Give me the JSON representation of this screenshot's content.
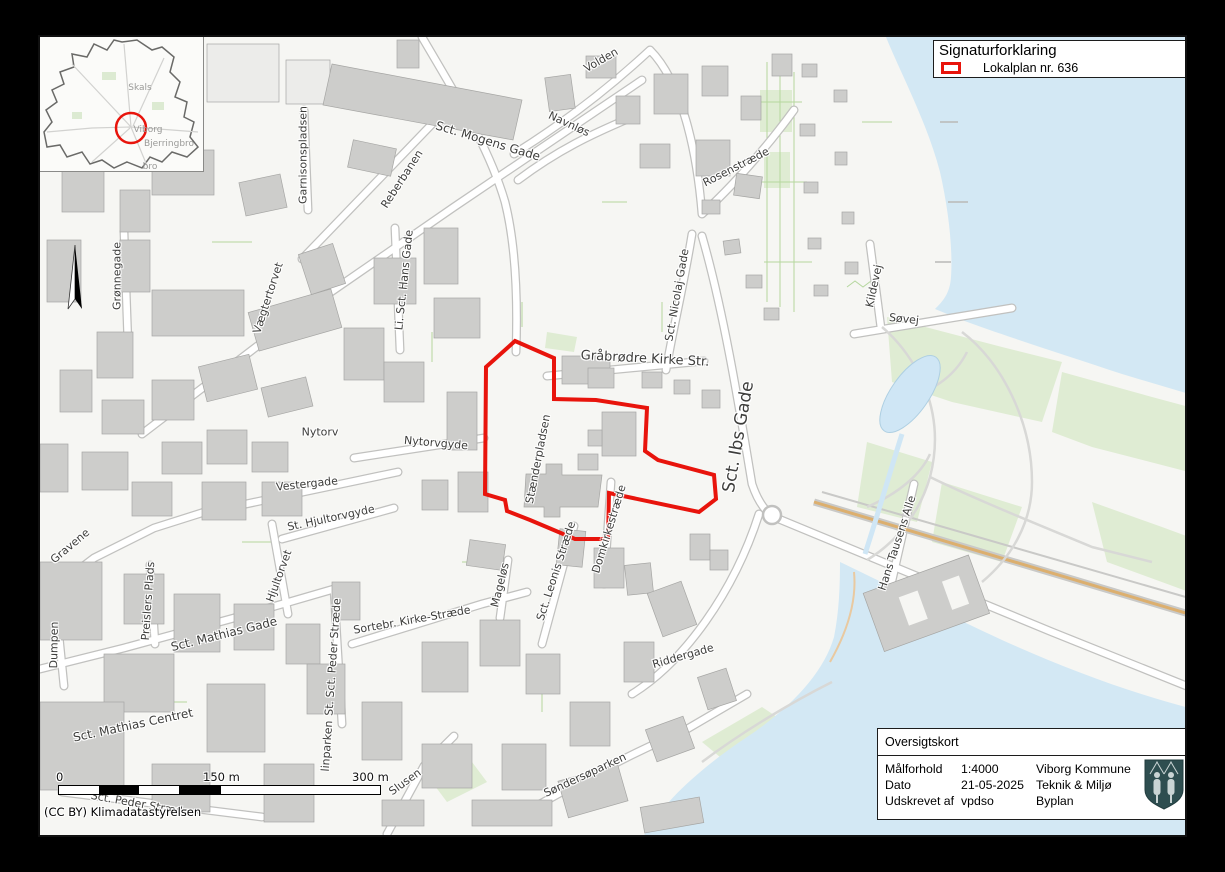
{
  "legend": {
    "title": "Signaturforklaring",
    "items": [
      {
        "label": "Lokalplan nr. 636",
        "symbol": "red-rectangle-outline",
        "color": "#e8140c"
      }
    ]
  },
  "info_box": {
    "title": "Oversigtskort",
    "rows": [
      {
        "label": "Målforhold",
        "value": "1:4000"
      },
      {
        "label": "Dato",
        "value": "21-05-2025"
      },
      {
        "label": "Udskrevet af",
        "value": "vpdso"
      }
    ],
    "org_lines": [
      "Viborg Kommune",
      "Teknik & Miljø",
      "Byplan"
    ],
    "emblem": "viborg-coat-of-arms"
  },
  "scale_bar": {
    "ticks": [
      "0",
      "150 m",
      "300 m"
    ]
  },
  "attribution": "(CC BY) Klimadatastyrelsen",
  "inset": {
    "marker": "red-circle",
    "labels": [
      {
        "text": "Skals",
        "x": 138,
        "y": 86
      },
      {
        "text": "Viborg",
        "x": 146,
        "y": 128
      },
      {
        "text": "Bjerringbro",
        "x": 167,
        "y": 142
      },
      {
        "text": "bro",
        "x": 148,
        "y": 165
      }
    ]
  },
  "map": {
    "lokalplan_boundary_points": "513,339 552,356 552,397 594,398 645,406 643,449 656,458 712,473 714,497 697,510 607,491 606,537 573,537 528,518 505,509 503,498 483,492 484,365",
    "colors": {
      "boundary": "#e8140c",
      "water": "#d3e8f4",
      "building": "#cdcdcb",
      "park": "#dfecd3",
      "background": "#f6f6f3",
      "railway": "#dcaf6e"
    },
    "street_labels": [
      {
        "text": "Volden",
        "x": 601,
        "y": 60,
        "rot": -30,
        "size": 11
      },
      {
        "text": "Navnløs",
        "x": 569,
        "y": 124,
        "rot": 25,
        "size": 11
      },
      {
        "text": "Sct. Mogens Gade",
        "x": 488,
        "y": 141,
        "rot": 17,
        "size": 12
      },
      {
        "text": "Rosenstræde",
        "x": 736,
        "y": 167,
        "rot": -27,
        "size": 11
      },
      {
        "text": "Garnisonspladsen",
        "x": 303,
        "y": 155,
        "rot": -90,
        "size": 11
      },
      {
        "text": "Reberbanen",
        "x": 402,
        "y": 179,
        "rot": -57,
        "size": 11
      },
      {
        "text": "Li. Sct. Hans Gade",
        "x": 404,
        "y": 280,
        "rot": -84,
        "size": 11
      },
      {
        "text": "Vægtertorvet",
        "x": 268,
        "y": 298,
        "rot": -72,
        "size": 11
      },
      {
        "text": "Grønnegade",
        "x": 117,
        "y": 276,
        "rot": -90,
        "size": 11
      },
      {
        "text": "Gråbrødre Kirke Str.",
        "x": 645,
        "y": 359,
        "rot": 3,
        "size": 13
      },
      {
        "text": "Sct. Nicolaj Gade",
        "x": 677,
        "y": 295,
        "rot": -80,
        "size": 11
      },
      {
        "text": "Sct. Ibs Gade",
        "x": 739,
        "y": 437,
        "rot": -80,
        "size": 17
      },
      {
        "text": "Stænderpladsen",
        "x": 538,
        "y": 459,
        "rot": -79,
        "size": 11
      },
      {
        "text": "Nytorv",
        "x": 320,
        "y": 432,
        "rot": 0,
        "size": 11
      },
      {
        "text": "Nytorvgyde",
        "x": 436,
        "y": 443,
        "rot": 5,
        "size": 11
      },
      {
        "text": "Vestergade",
        "x": 307,
        "y": 484,
        "rot": -6,
        "size": 11
      },
      {
        "text": "St. Hjultorvgyde",
        "x": 331,
        "y": 518,
        "rot": -12,
        "size": 11
      },
      {
        "text": "Hjultorvet",
        "x": 279,
        "y": 576,
        "rot": -70,
        "size": 11
      },
      {
        "text": "Gravene",
        "x": 70,
        "y": 546,
        "rot": -40,
        "size": 11
      },
      {
        "text": "Preislers Plads",
        "x": 148,
        "y": 601,
        "rot": -86,
        "size": 11
      },
      {
        "text": "Dumpen",
        "x": 54,
        "y": 645,
        "rot": -89,
        "size": 11
      },
      {
        "text": "Sct. Mathias Gade",
        "x": 224,
        "y": 634,
        "rot": -14,
        "size": 12
      },
      {
        "text": "St. Sct. Peder Stræde",
        "x": 333,
        "y": 657,
        "rot": -86,
        "size": 11
      },
      {
        "text": "Sortebr. Kirke-Stræde",
        "x": 412,
        "y": 620,
        "rot": -10,
        "size": 11
      },
      {
        "text": "Mageløs",
        "x": 500,
        "y": 585,
        "rot": -76,
        "size": 11
      },
      {
        "text": "Sct. Leonis Stræde",
        "x": 556,
        "y": 571,
        "rot": -72,
        "size": 11
      },
      {
        "text": "Domkirkestræde",
        "x": 609,
        "y": 529,
        "rot": -73,
        "size": 11
      },
      {
        "text": "Riddergade",
        "x": 683,
        "y": 656,
        "rot": -16,
        "size": 11
      },
      {
        "text": "Søndersøparken",
        "x": 585,
        "y": 775,
        "rot": -25,
        "size": 11
      },
      {
        "text": "Slusen",
        "x": 405,
        "y": 782,
        "rot": -36,
        "size": 11
      },
      {
        "text": "linparken",
        "x": 327,
        "y": 746,
        "rot": -86,
        "size": 11
      },
      {
        "text": "Sct. Mathias Centret",
        "x": 133,
        "y": 725,
        "rot": -12,
        "size": 12
      },
      {
        "text": "Sct. Peder Stræde",
        "x": 140,
        "y": 804,
        "rot": 10,
        "size": 11
      },
      {
        "text": "Hans Tausens Alle",
        "x": 897,
        "y": 543,
        "rot": -72,
        "size": 11
      },
      {
        "text": "Kildevej",
        "x": 874,
        "y": 286,
        "rot": -78,
        "size": 11
      },
      {
        "text": "Søvej",
        "x": 904,
        "y": 319,
        "rot": 6,
        "size": 11
      }
    ]
  }
}
